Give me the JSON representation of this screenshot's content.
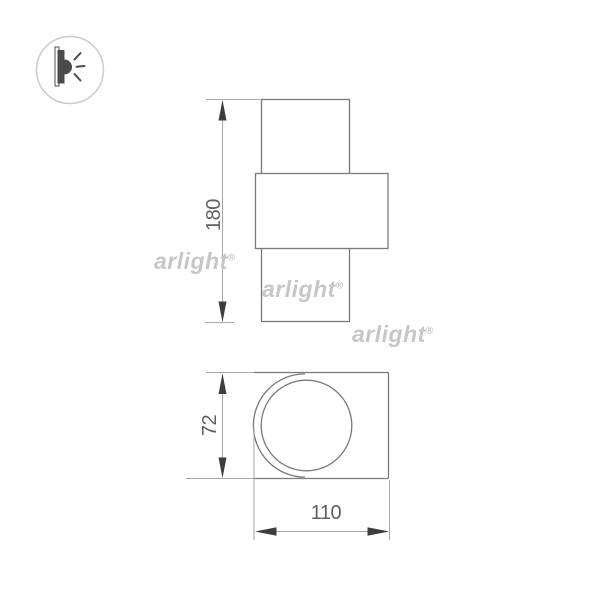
{
  "product_drawing": {
    "type": "wall-lamp-dimension-drawing",
    "views": {
      "front": {
        "dim_height": {
          "value": "180"
        }
      },
      "bottom": {
        "dim_height": {
          "value": "72"
        },
        "dim_width": {
          "value": "110"
        }
      }
    }
  },
  "watermarks": [
    {
      "text": "arlight",
      "reg": "®"
    },
    {
      "text": "arlight",
      "reg": "®"
    },
    {
      "text": "arlight",
      "reg": "®"
    }
  ],
  "icon_badge": {
    "meaning": "wall-mounted-light-side-view"
  },
  "colors": {
    "background": "#ffffff",
    "outline": "#7a7a7a",
    "dim_line": "#a6a6a6",
    "arrow": "#3d3d3d",
    "dim_text": "#606060",
    "watermark": "#c7c7c7",
    "icon": "#4b4b4b",
    "icon_circle": "#cbcbcb"
  }
}
